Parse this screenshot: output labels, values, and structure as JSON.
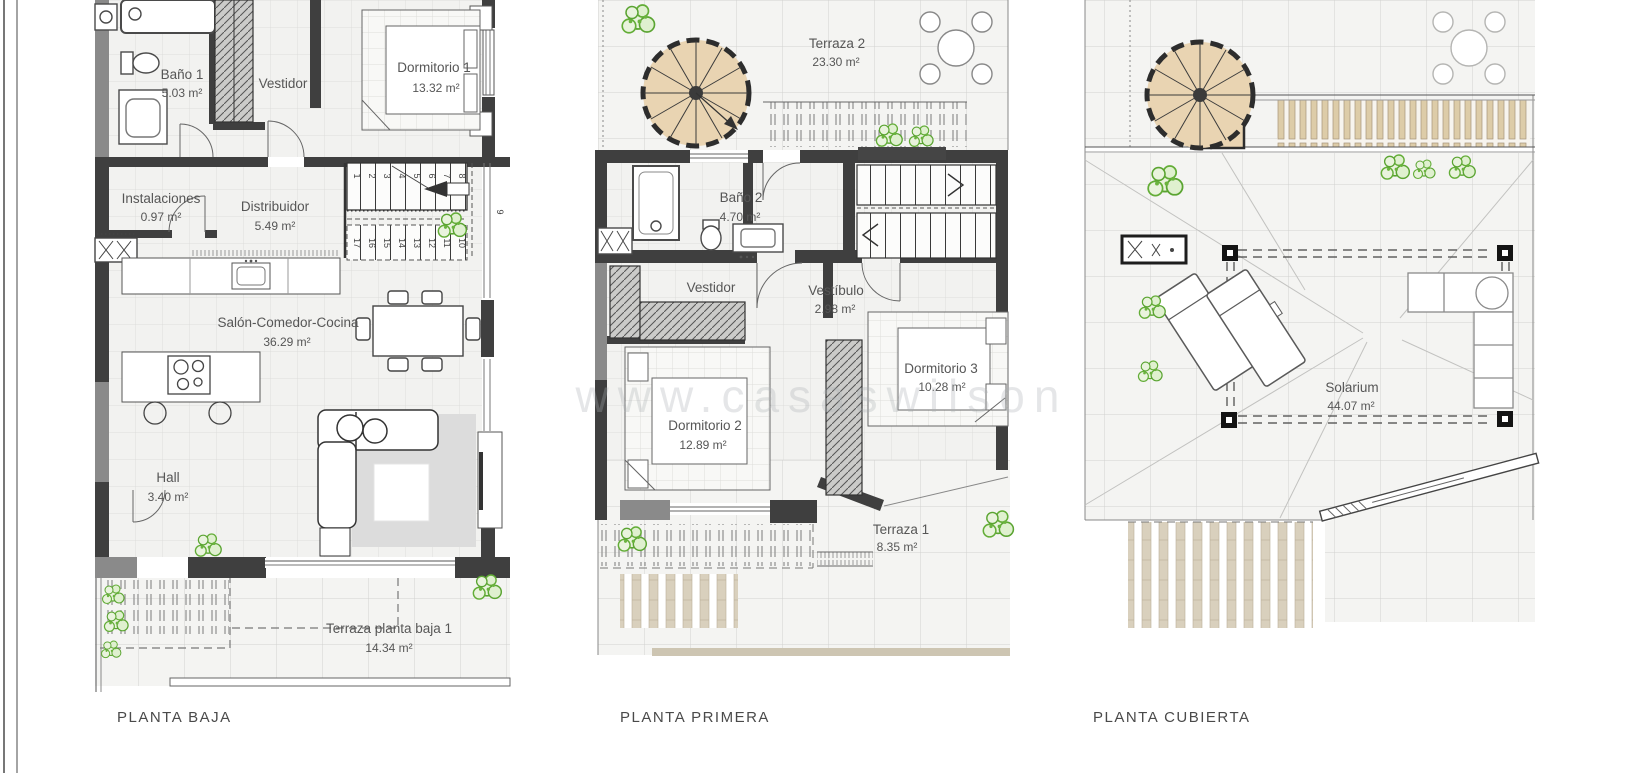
{
  "watermark": "www.casaswilson",
  "plans": [
    {
      "title": "PLANTA BAJA",
      "rooms": {
        "bano1": {
          "name": "Baño 1",
          "area": "5.03 m²"
        },
        "vestidor": {
          "name": "Vestidor",
          "area": ""
        },
        "dormitorio1": {
          "name": "Dormitorio 1",
          "area": "13.32 m²"
        },
        "instalaciones": {
          "name": "Instalaciones",
          "area": "0.97 m²"
        },
        "distribuidor": {
          "name": "Distribuidor",
          "area": "5.49 m²"
        },
        "salon": {
          "name": "Salón-Comedor-Cocina",
          "area": "36.29 m²"
        },
        "hall": {
          "name": "Hall",
          "area": "3.40 m²"
        },
        "terraza": {
          "name": "Terraza planta baja 1",
          "area": "14.34 m²"
        }
      },
      "stair_numbers_up": [
        "1",
        "2",
        "3",
        "4",
        "5",
        "6",
        "7",
        "8"
      ],
      "stair_numbers_down": [
        "17",
        "16",
        "15",
        "14",
        "13",
        "12",
        "11",
        "10"
      ],
      "stair_number_side": "9"
    },
    {
      "title": "PLANTA PRIMERA",
      "rooms": {
        "terraza2": {
          "name": "Terraza 2",
          "area": "23.30 m²"
        },
        "bano2": {
          "name": "Baño 2",
          "area": "4.70 m²"
        },
        "vestidor": {
          "name": "Vestidor",
          "area": ""
        },
        "vestibulo": {
          "name": "Vestíbulo",
          "area": "2.98 m²"
        },
        "dormitorio2": {
          "name": "Dormitorio 2",
          "area": "12.89 m²"
        },
        "dormitorio3": {
          "name": "Dormitorio 3",
          "area": "10.28 m²"
        },
        "terraza1": {
          "name": "Terraza 1",
          "area": "8.35 m²"
        }
      }
    },
    {
      "title": "PLANTA CUBIERTA",
      "rooms": {
        "solarium": {
          "name": "Solarium",
          "area": "44.07 m²"
        }
      }
    }
  ]
}
